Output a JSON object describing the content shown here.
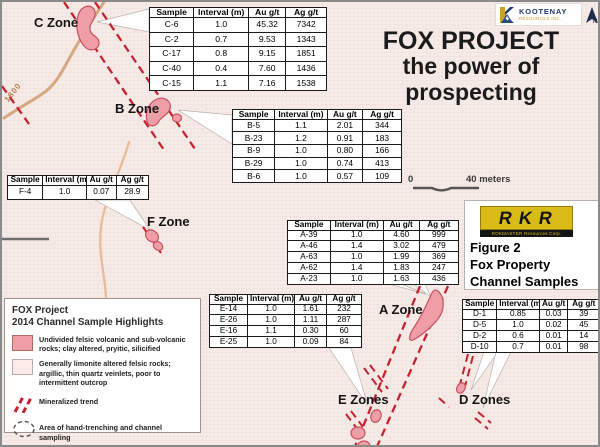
{
  "title": {
    "line1": "FOX PROJECT",
    "line2": "the power of prospecting"
  },
  "header_logo": {
    "company": "KOOTENAY",
    "company_sub": "RESOURCES INC.",
    "north": "N"
  },
  "figure_box": {
    "logo_acronym": "RKR",
    "logo_bar": "ROKMASTER Resources Corp.",
    "caption_line1": "Figure 2",
    "caption_line2": "Fox Property",
    "caption_line3": "Channel Samples"
  },
  "scale_bar": {
    "zero": "0",
    "max": "40 meters"
  },
  "map": {
    "contour_label": "1800",
    "zone_labels": {
      "c": "C Zone",
      "b": "B Zone",
      "f": "F Zone",
      "a": "A Zone",
      "e": "E Zones",
      "d": "D Zones"
    }
  },
  "table_headers": [
    "Sample",
    "Interval (m)",
    "Au g/t",
    "Ag g/t"
  ],
  "tables": {
    "c_zone": {
      "rows": [
        [
          "C-6",
          "1.0",
          "45.32",
          "7342"
        ],
        [
          "C-2",
          "0.7",
          "9.53",
          "1343"
        ],
        [
          "C-17",
          "0.8",
          "9.15",
          "1851"
        ],
        [
          "C-40",
          "0.4",
          "7.60",
          "1436"
        ],
        [
          "C-15",
          "1.1",
          "7.16",
          "1538"
        ]
      ]
    },
    "b_zone": {
      "rows": [
        [
          "B-5",
          "1.1",
          "2.01",
          "344"
        ],
        [
          "B-23",
          "1.2",
          "0.91",
          "183"
        ],
        [
          "B-9",
          "1.0",
          "0.80",
          "166"
        ],
        [
          "B-29",
          "1.0",
          "0.74",
          "413"
        ],
        [
          "B-6",
          "1.0",
          "0.57",
          "109"
        ]
      ]
    },
    "f_zone": {
      "rows": [
        [
          "F-4",
          "1.0",
          "0.07",
          "28.9"
        ]
      ]
    },
    "a_zone": {
      "rows": [
        [
          "A-39",
          "1.0",
          "4.60",
          "999"
        ],
        [
          "A-46",
          "1.4",
          "3.02",
          "479"
        ],
        [
          "A-63",
          "1.0",
          "1.99",
          "369"
        ],
        [
          "A-62",
          "1.4",
          "1.83",
          "247"
        ],
        [
          "A-23",
          "1.0",
          "1.63",
          "436"
        ]
      ]
    },
    "e_zone": {
      "rows": [
        [
          "E-14",
          "1.0",
          "1.61",
          "232"
        ],
        [
          "E-26",
          "1.0",
          "1.11",
          "287"
        ],
        [
          "E-16",
          "1.1",
          "0.30",
          "60"
        ],
        [
          "E-25",
          "1.0",
          "0.09",
          "84"
        ]
      ]
    },
    "d_zone": {
      "rows": [
        [
          "D-1",
          "0.85",
          "0.03",
          "39"
        ],
        [
          "D-5",
          "1.0",
          "0.02",
          "45"
        ],
        [
          "D-2",
          "0.6",
          "0.01",
          "14"
        ],
        [
          "D-10",
          "0.7",
          "0.01",
          "98"
        ]
      ]
    }
  },
  "legend": {
    "title_line1": "FOX Project",
    "title_line2": "2014 Channel Sample Highlights",
    "item1": "Undivided felsic volcanic and sub-volcanic rocks; clay altered, pryitic, silicified",
    "item2": "Generally limonite altered felsic rocks; argillic, thin quartz veinlets, poor to intermittent outcrop",
    "item3": "Mineralized trend",
    "item4": "Area of hand-trenching and channel sampling"
  },
  "colors": {
    "background": "#f7ebe7",
    "zone_fill": "#ef9ea7",
    "zone_stroke": "#c5515f",
    "mineralized_trend": "#c32330",
    "contour": "#cf9c6f",
    "kootenay_navy": "#233a6b",
    "kootenay_gold": "#c9a22c",
    "rkr_yellow": "#d9bb17"
  }
}
